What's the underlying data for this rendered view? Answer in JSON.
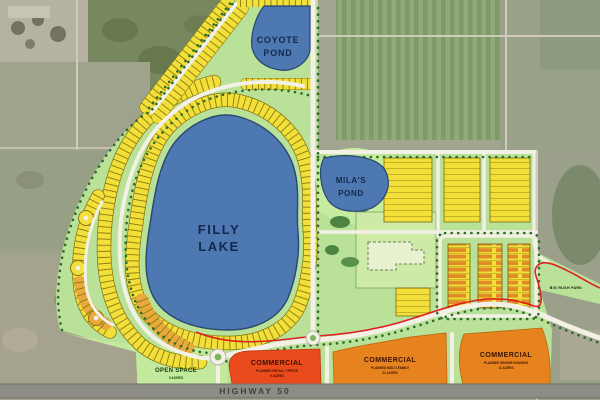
{
  "map": {
    "type": "master-plan-site-map",
    "water_labels": {
      "filly_lake": [
        "FILLY",
        "LAKE"
      ],
      "coyote_pond": [
        "COYOTE",
        "POND"
      ],
      "milas_pond": [
        "MILA'S",
        "POND"
      ]
    },
    "parcels": {
      "open_space": {
        "title": "OPEN SPACE",
        "acres": "9 ACRES"
      },
      "commercial_retail": {
        "title": "COMMERCIAL",
        "subtitle": "PLANNED RETAIL / OFFICE",
        "acres": "9 ACRES"
      },
      "commercial_multifamily": {
        "title": "COMMERCIAL",
        "subtitle": "PLANNED MULTI-FAMILY",
        "acres": "21 ACRES"
      },
      "commercial_senior": {
        "title": "COMMERCIAL",
        "subtitle": "PLANNED SENIOR HOUSING",
        "acres": "11 ACRES"
      }
    },
    "roads": {
      "highway_label": "HIGHWAY 50"
    },
    "landmarks": {
      "park_label": "BIG RUSH PARK"
    },
    "legend_colors": {
      "lake_water": "#4e78b1",
      "residential_lots": "#f2df3a",
      "shaded_lots": "#e9a93c",
      "open_space_green": "#b9e197",
      "commercial_retail_red": "#ea4a1c",
      "commercial_orange": "#e6831f",
      "boundary_red": "#e0151e",
      "road_white": "#f3f0e6",
      "highway_gray": "#8e8d85",
      "street_trees_green": "#2e6b2e"
    }
  }
}
